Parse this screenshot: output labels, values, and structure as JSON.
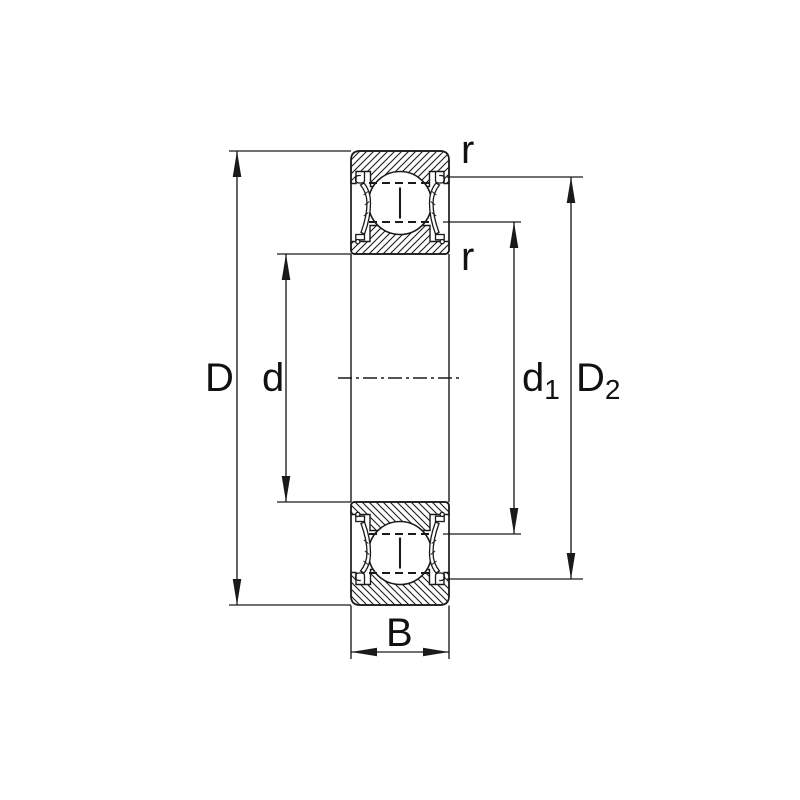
{
  "diagram": {
    "type": "bearing-cross-section",
    "background": "#ffffff",
    "line_color": "#1a1a1a",
    "labels": {
      "D": "D",
      "d": "d",
      "d1_base": "d",
      "d1_sub": "1",
      "D2_base": "D",
      "D2_sub": "2",
      "B": "B",
      "r_outer": "r",
      "r_inner": "r"
    }
  }
}
